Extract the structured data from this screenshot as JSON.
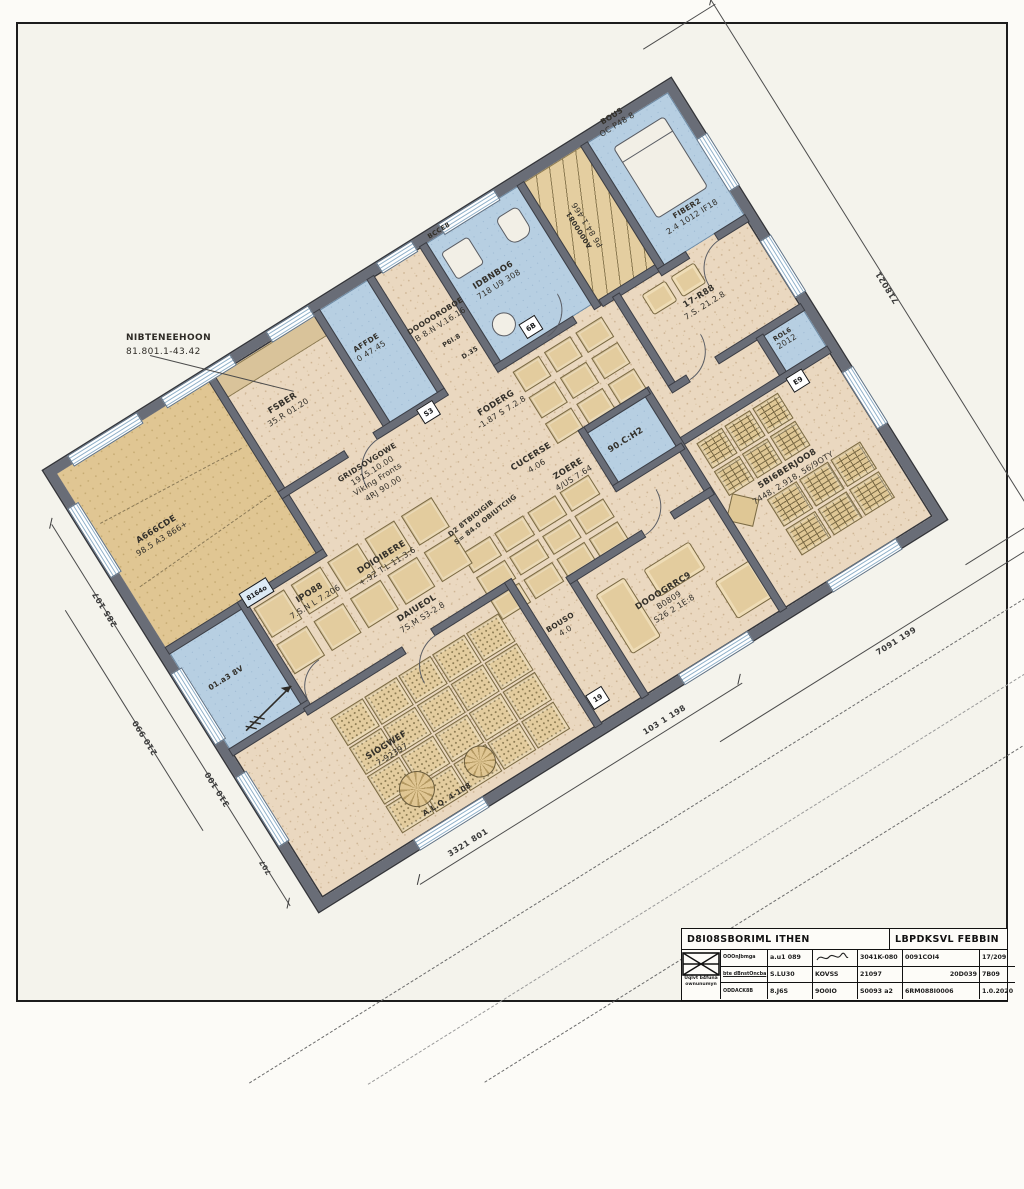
{
  "rooms": {
    "nw_hall": {
      "l1": "A666CDE",
      "l2": "98.5 A3 866+"
    },
    "feber": {
      "l1": "FSBER",
      "l2": "35.R 01.20"
    },
    "affde": {
      "l1": "AFFDE",
      "l2": "0 47.45"
    },
    "corridor": {
      "l1": "DOOOOROBOE",
      "l2": "B 8.N V.16.16"
    },
    "d35": {
      "l1": "D.35"
    },
    "bcce8": {
      "l1": "BCCE8"
    },
    "p6l8": {
      "l1": "P6l.8"
    },
    "bath": {
      "l1": "IDBNBO6",
      "l2": "718 U9 308"
    },
    "wardrobe": {
      "l1": "A0000081",
      "l2": "P6 84.1.466"
    },
    "bous": {
      "l1": "BOUS",
      "l2": "OC P48 8"
    },
    "fiber": {
      "l1": "FIBER2",
      "l2": "2.4 1012 IF18"
    },
    "r1788": {
      "l1": "17-R88",
      "l2": "7.S. 21.2.8"
    },
    "rol6": {
      "l1": "ROL6",
      "l2": "2012"
    },
    "office": {
      "l1": "5BI6BERJOO8",
      "l2": "7448, 2.918, 56/9OTY"
    },
    "ch2": {
      "l1": "90.C:H2"
    },
    "grids": {
      "l1": "GRIDSOVGOWE",
      "l2": "1915.10.00",
      "l3": "Viking Fronts",
      "l4": "4RJ 90.00"
    },
    "foderg": {
      "l1": "FODERG",
      "l2": "-1.87 S 7.2.8"
    },
    "cucerse": {
      "l1": "CUCERSE",
      "l2": "4.06"
    },
    "zoere": {
      "l1": "ZOERE",
      "l2": "4/US 7.64"
    },
    "doioibere": {
      "l1": "DOIOIBERE",
      "l2": "+.92 T.L 11.3:6"
    },
    "daiueol": {
      "l1": "DAIUEOL",
      "l2": "7S.M S3-2.8"
    },
    "ipo88": {
      "l1": "IPO88",
      "l2": "7.S.N L 7.206"
    },
    "siogwef": {
      "l1": "SIOGWEF",
      "l2": "7-92397",
      "l3": "A.L.Q. 4-108"
    },
    "bouso": {
      "l1": "BOUSO",
      "l2": "4.0"
    },
    "lounge": {
      "l1": "DOOOGRRC9",
      "l2": "B0809",
      "l3": "S26 2 1E:8"
    },
    "blue_left": {
      "l1": "01.a3 8V"
    },
    "cell": {
      "l1": "8164o"
    }
  },
  "shafts": {
    "a": "S3",
    "b": "6B",
    "c": "19",
    "d": "E9"
  },
  "dims": {
    "ne": "718021",
    "bottom_near_left": "3321 801",
    "bottom_near_right": "103 1 198",
    "bottom_far": "7091 199",
    "left_upper": "285 107",
    "left_lower": "310 100",
    "left_small": "707",
    "left_outer": "210 990"
  },
  "notes": {
    "main1": "NIBTENEEHOON",
    "main2": "81.801.1-43.42",
    "scribble1": "D2 8TBIOIGIB",
    "scribble2": "S= 84.0 OBIUTCIIG"
  },
  "title_block": {
    "name_left": "D8I08SBORIML ITHEN",
    "name_right": "LBPDKSVL FEBBIN",
    "logo_caption": "Uqlvt b4funa ownunumyn",
    "col_labels": [
      "OOOnJbmga",
      "bte dBnstOncba",
      "ODDACK8B"
    ],
    "r1": [
      "a.u1 089",
      "3041K-080",
      "0091COI4",
      "17/209"
    ],
    "r2": [
      "S.LU30",
      "KOVSS",
      "21097",
      "20D039",
      "7B09"
    ],
    "r3": [
      "8.J6S",
      "9O0IO",
      "S0093 a2",
      "6RM088I0006",
      "1.0.2020"
    ]
  }
}
